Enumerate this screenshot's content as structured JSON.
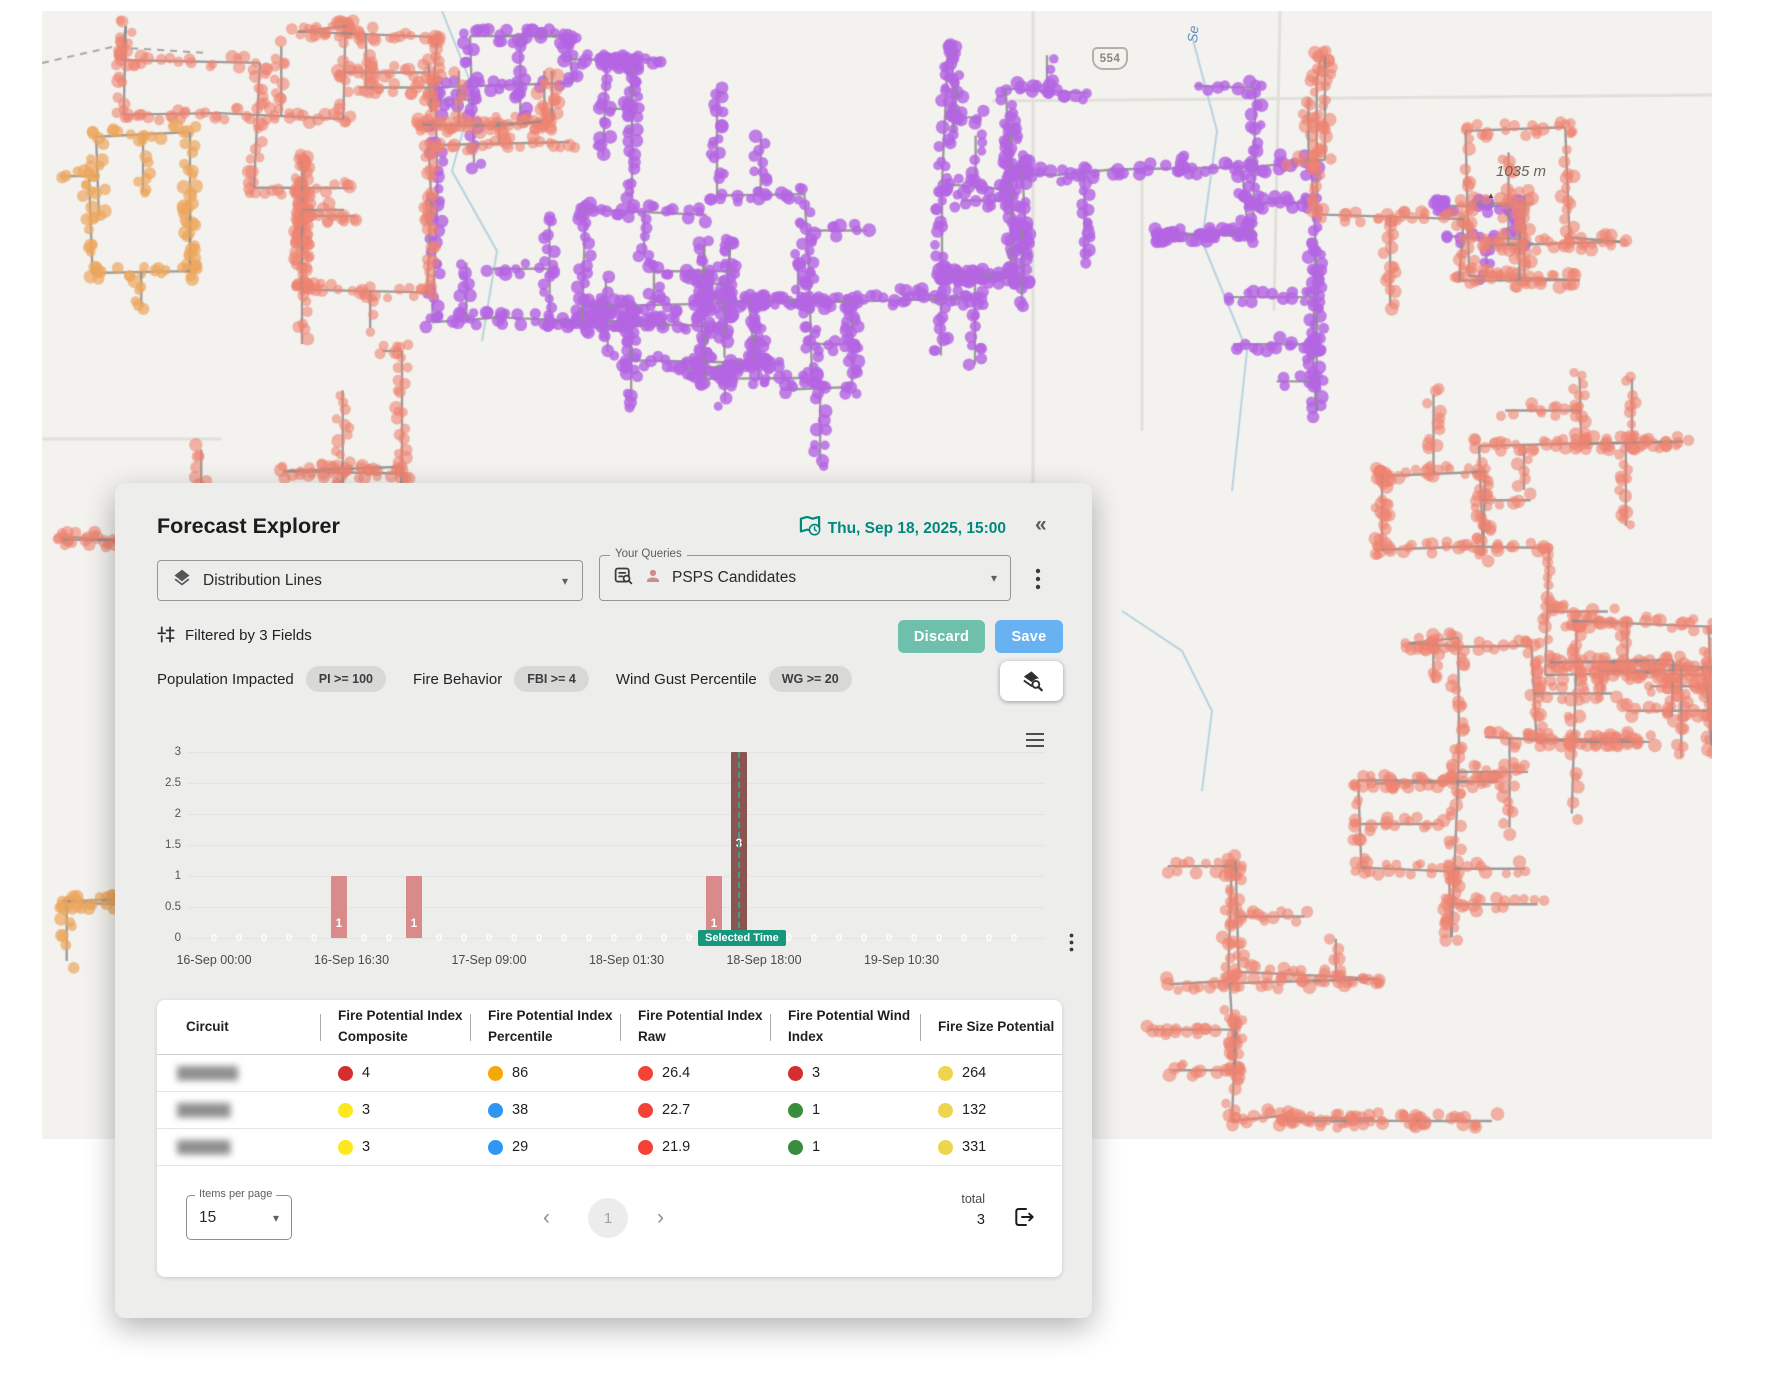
{
  "map": {
    "bg": "#f3f2ee",
    "road_label": "554",
    "river_label": "Se",
    "elevation_label": "1035 m",
    "colors": {
      "purple": "#b565e3",
      "salmon": "#ef8371",
      "orange": "#eda65e",
      "line": "#8d8d8d"
    }
  },
  "panel": {
    "title": "Forecast Explorer",
    "datetime": "Thu, Sep 18, 2025, 15:00",
    "layer_select": {
      "value": "Distribution Lines"
    },
    "queries": {
      "label": "Your Queries",
      "value": "PSPS Candidates"
    },
    "filter_summary": "Filtered by 3 Fields",
    "buttons": {
      "discard": "Discard",
      "save": "Save"
    },
    "filters": [
      {
        "name": "Population Impacted",
        "chip": "PI >= 100"
      },
      {
        "name": "Fire Behavior",
        "chip": "FBI >= 4"
      },
      {
        "name": "Wind Gust Percentile",
        "chip": "WG >= 20"
      }
    ]
  },
  "chart_data": {
    "type": "bar",
    "title": "",
    "start_time": "16-Sep 00:00",
    "slot_interval_hours": 3,
    "num_slots": 33,
    "values": [
      0,
      0,
      0,
      0,
      0,
      1,
      0,
      0,
      1,
      0,
      0,
      0,
      0,
      0,
      0,
      0,
      0,
      0,
      0,
      0,
      1,
      3,
      0,
      0,
      0,
      0,
      0,
      0,
      0,
      0,
      0,
      0,
      0
    ],
    "selected_slot": 21,
    "selected_time_label": "Selected Time",
    "x_tick_labels": [
      "16-Sep 00:00",
      "16-Sep 16:30",
      "17-Sep 09:00",
      "18-Sep 01:30",
      "18-Sep 18:00",
      "19-Sep 10:30"
    ],
    "x_tick_slots": [
      0,
      5.5,
      11,
      16.5,
      22,
      27.5
    ],
    "y_ticks": [
      "0",
      "0.5",
      "1",
      "1.5",
      "2",
      "2.5",
      "3"
    ],
    "ylim": [
      0,
      3
    ],
    "grid": true,
    "bar_color": "#d98a8a",
    "selected_bar_color": "#8a5450"
  },
  "table": {
    "columns": [
      {
        "l1": "Circuit",
        "l2": ""
      },
      {
        "l1": "Fire Potential Index",
        "l2": "Composite"
      },
      {
        "l1": "Fire Potential Index",
        "l2": "Percentile"
      },
      {
        "l1": "Fire Potential Index",
        "l2": "Raw"
      },
      {
        "l1": "Fire Potential Wind",
        "l2": "Index"
      },
      {
        "l1": "Fire Size Potential",
        "l2": ""
      }
    ],
    "rows": [
      {
        "circuit": "████████",
        "cells": [
          {
            "color": "#d32f2f",
            "value": "4"
          },
          {
            "color": "#f6a609",
            "value": "86"
          },
          {
            "color": "#f44336",
            "value": "26.4"
          },
          {
            "color": "#d32f2f",
            "value": "3"
          },
          {
            "color": "#eed54e",
            "value": "264"
          }
        ]
      },
      {
        "circuit": "███████",
        "cells": [
          {
            "color": "#fce81c",
            "value": "3"
          },
          {
            "color": "#2f96f3",
            "value": "38"
          },
          {
            "color": "#f44336",
            "value": "22.7"
          },
          {
            "color": "#388e3c",
            "value": "1"
          },
          {
            "color": "#eed54e",
            "value": "132"
          }
        ]
      },
      {
        "circuit": "███████",
        "cells": [
          {
            "color": "#fce81c",
            "value": "3"
          },
          {
            "color": "#2f96f3",
            "value": "29"
          },
          {
            "color": "#f44336",
            "value": "21.9"
          },
          {
            "color": "#388e3c",
            "value": "1"
          },
          {
            "color": "#eed54e",
            "value": "331"
          }
        ]
      }
    ]
  },
  "footer": {
    "items_per_page_label": "Items per page",
    "items_per_page": "15",
    "page": "1",
    "total_label": "total",
    "total": "3"
  },
  "icons": {
    "collapse": "«",
    "caret": "▾",
    "prev": "‹",
    "next": "›",
    "peak": "▲"
  }
}
